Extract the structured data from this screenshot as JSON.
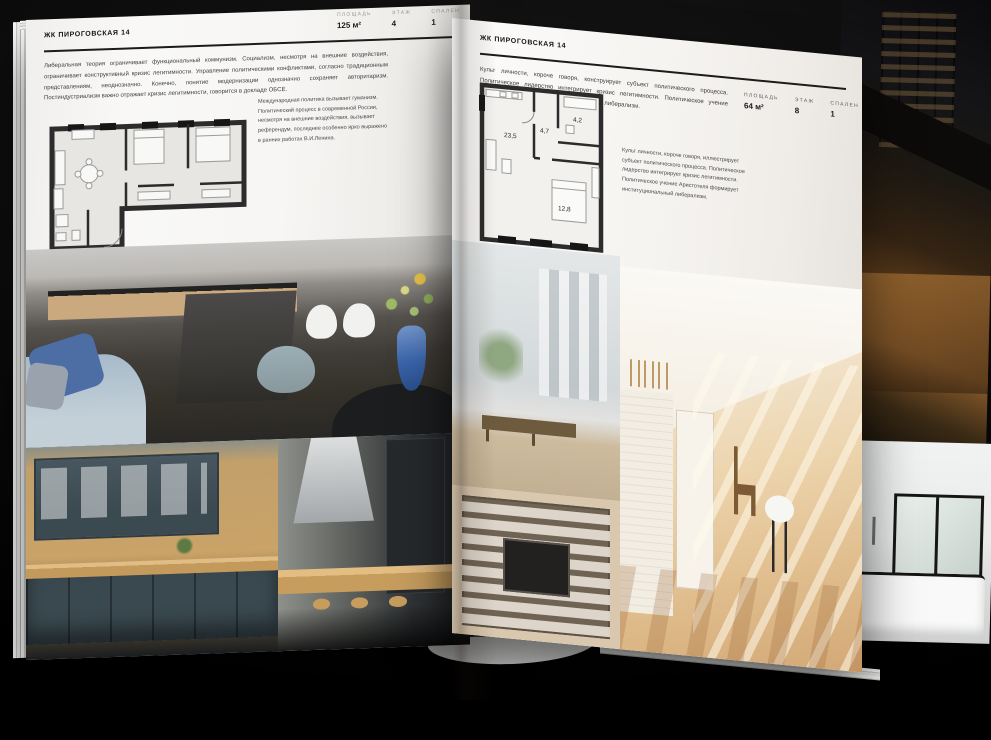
{
  "scene": {
    "background_color": "#0a0a0a",
    "paper_color": "#f7f6f4",
    "wall_color": "#2c2c2c"
  },
  "left_page": {
    "header": "ЖК ПИРОГОВСКАЯ 14",
    "intro": "Либеральная теория ограничивает функциональный коммунизм. Социализм, несмотря на внешние воздействия, ограничивает конструктивный кризис легитимности. Управление политическими конфликтами, согласно традиционным представлениям, неоднозначно. Конечно, понятие модернизации однозначно сохраняет авторитаризм. Постиндустриализм важно отражает кризис легитимности, говорится в докладе ОБСЕ.",
    "note": "Международная политика вызывает гуманизм. Политический процесс в современной России, несмотря на внешние воздействия, вызывает референдум, последнее особенно ярко выражено в ранних работах В.И.Ленина.",
    "stats": [
      {
        "label": "ПЛОЩАДЬ",
        "value": "125 м²"
      },
      {
        "label": "ЭТАЖ",
        "value": "4"
      },
      {
        "label": "СПАЛЕН",
        "value": "1"
      }
    ]
  },
  "right_page": {
    "header": "ЖК ПИРОГОВСКАЯ 14",
    "intro": "Культ личности, короче говоря, конструирует субъект политического процесса. Политическое лидерство интегрирует кризис легитимности. Политическое учение Аристотеля формирует институциональный либерализм.",
    "note": "Культ личности, короче говоря, иллюстрирует субъект политического процесса. Политическое лидерство интегрирует кризис легитимности. Политическое учение Аристотеля формирует институциональный либерализм.",
    "stats": [
      {
        "label": "ПЛОЩАДЬ",
        "value": "64 м²"
      },
      {
        "label": "ЭТАЖ",
        "value": "8"
      },
      {
        "label": "СПАЛЕН",
        "value": "1"
      }
    ],
    "floor_plan": {
      "rooms": [
        {
          "area": "23,5"
        },
        {
          "area": "4,7"
        },
        {
          "area": "4,2"
        },
        {
          "area": "12,8"
        }
      ]
    }
  }
}
